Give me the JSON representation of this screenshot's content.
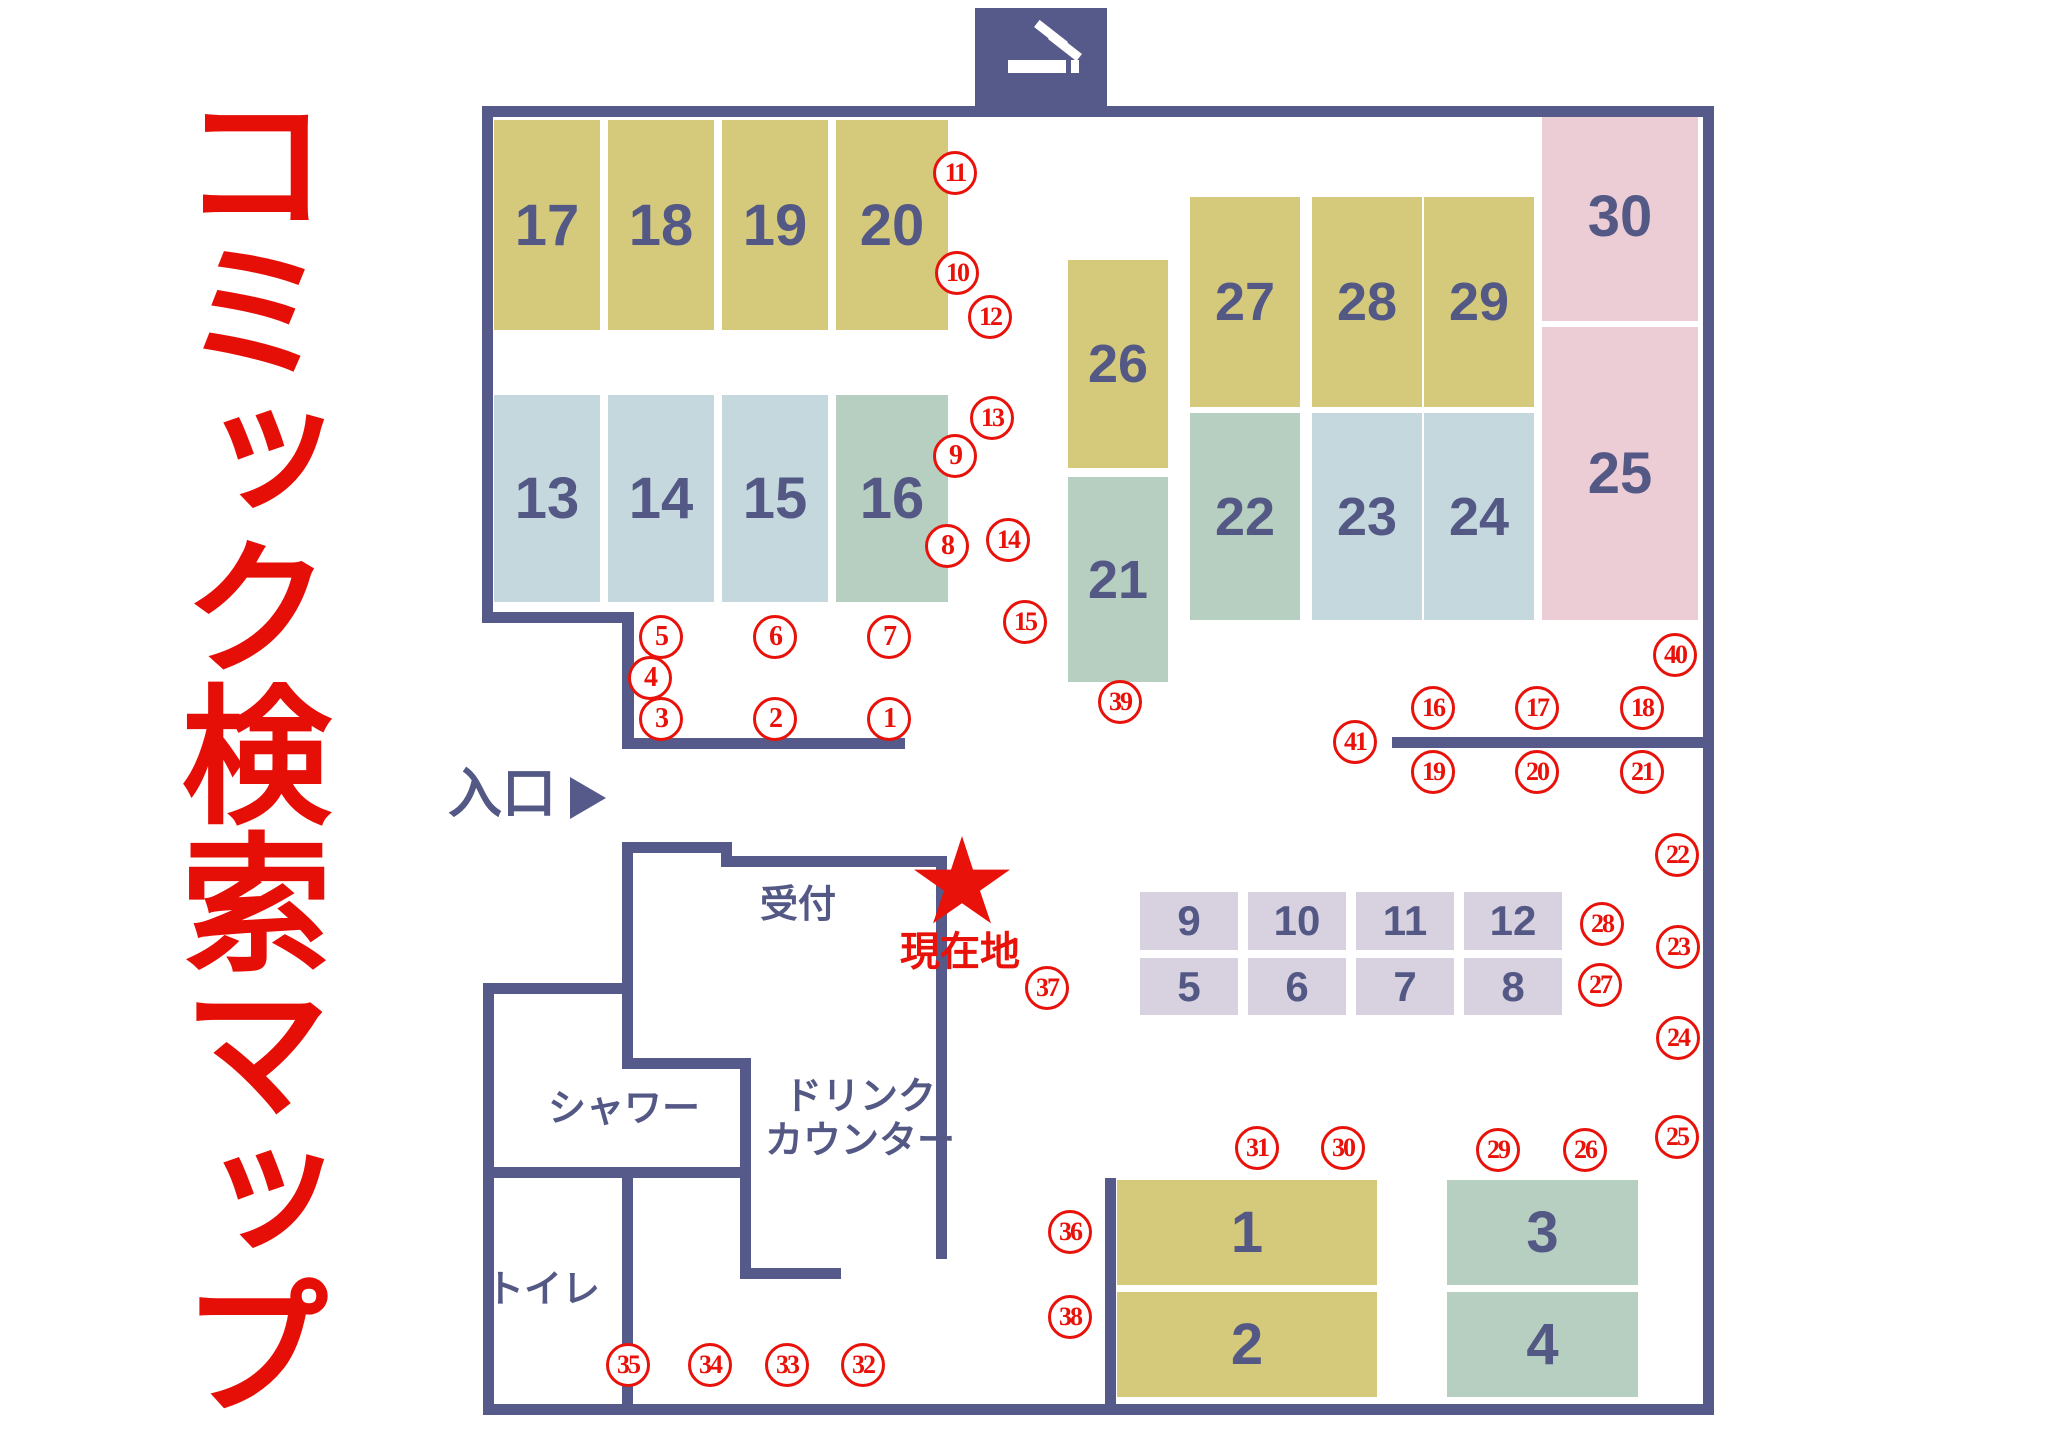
{
  "title": {
    "text": "コミック検索マップ",
    "color": "#e60f08"
  },
  "palette": {
    "wall": "#565a8b",
    "shelf_text": "#545885",
    "marker_red": "#e8120a",
    "yellow": "#d5ca7c",
    "lightblue": "#c5d8de",
    "green": "#b7cfc0",
    "pink": "#eccdd6",
    "lavender": "#d7d1e0"
  },
  "smoking_sign": {
    "icon": "cigarette-icon",
    "x": 975,
    "y": 8,
    "w": 132,
    "h": 99
  },
  "current_location": {
    "label": "現在地",
    "star_x": 962,
    "star_y": 884
  },
  "walls": [
    {
      "x": 482,
      "y": 106,
      "w": 1232,
      "h": 11
    },
    {
      "x": 1703,
      "y": 106,
      "w": 11,
      "h": 1309
    },
    {
      "x": 483,
      "y": 1404,
      "w": 1231,
      "h": 11
    },
    {
      "x": 482,
      "y": 106,
      "w": 11,
      "h": 517
    },
    {
      "x": 482,
      "y": 612,
      "w": 152,
      "h": 11
    },
    {
      "x": 622,
      "y": 612,
      "w": 12,
      "h": 137
    },
    {
      "x": 622,
      "y": 738,
      "w": 283,
      "h": 11
    },
    {
      "x": 483,
      "y": 983,
      "w": 11,
      "h": 432
    },
    {
      "x": 483,
      "y": 983,
      "w": 150,
      "h": 11
    },
    {
      "x": 483,
      "y": 1167,
      "w": 268,
      "h": 11
    },
    {
      "x": 622,
      "y": 1167,
      "w": 11,
      "h": 248
    },
    {
      "x": 622,
      "y": 842,
      "w": 11,
      "h": 227
    },
    {
      "x": 622,
      "y": 842,
      "w": 110,
      "h": 11
    },
    {
      "x": 721,
      "y": 842,
      "w": 11,
      "h": 25
    },
    {
      "x": 721,
      "y": 856,
      "w": 226,
      "h": 11
    },
    {
      "x": 936,
      "y": 856,
      "w": 11,
      "h": 403
    },
    {
      "x": 622,
      "y": 1058,
      "w": 129,
      "h": 11
    },
    {
      "x": 740,
      "y": 1058,
      "w": 11,
      "h": 221
    },
    {
      "x": 740,
      "y": 1268,
      "w": 101,
      "h": 11
    },
    {
      "x": 1105,
      "y": 1178,
      "w": 11,
      "h": 237
    },
    {
      "x": 1392,
      "y": 737,
      "w": 312,
      "h": 11
    }
  ],
  "shelves": [
    {
      "label": "17",
      "x": 494,
      "y": 120,
      "w": 106,
      "h": 210,
      "color": "yellow",
      "fs": 58
    },
    {
      "label": "18",
      "x": 608,
      "y": 120,
      "w": 106,
      "h": 210,
      "color": "yellow",
      "fs": 58
    },
    {
      "label": "19",
      "x": 722,
      "y": 120,
      "w": 106,
      "h": 210,
      "color": "yellow",
      "fs": 58
    },
    {
      "label": "20",
      "x": 836,
      "y": 120,
      "w": 112,
      "h": 210,
      "color": "yellow",
      "fs": 58
    },
    {
      "label": "13",
      "x": 494,
      "y": 395,
      "w": 106,
      "h": 207,
      "color": "lightblue",
      "fs": 58
    },
    {
      "label": "14",
      "x": 608,
      "y": 395,
      "w": 106,
      "h": 207,
      "color": "lightblue",
      "fs": 58
    },
    {
      "label": "15",
      "x": 722,
      "y": 395,
      "w": 106,
      "h": 207,
      "color": "lightblue",
      "fs": 58
    },
    {
      "label": "16",
      "x": 836,
      "y": 395,
      "w": 112,
      "h": 207,
      "color": "green",
      "fs": 58
    },
    {
      "label": "26",
      "x": 1068,
      "y": 260,
      "w": 100,
      "h": 208,
      "color": "yellow",
      "fs": 54
    },
    {
      "label": "27",
      "x": 1190,
      "y": 197,
      "w": 110,
      "h": 210,
      "color": "yellow",
      "fs": 54
    },
    {
      "label": "28",
      "x": 1312,
      "y": 197,
      "w": 110,
      "h": 210,
      "color": "yellow",
      "fs": 54
    },
    {
      "label": "29",
      "x": 1424,
      "y": 197,
      "w": 110,
      "h": 210,
      "color": "yellow",
      "fs": 54
    },
    {
      "label": "30",
      "x": 1542,
      "y": 112,
      "w": 156,
      "h": 209,
      "color": "pink",
      "fs": 58
    },
    {
      "label": "21",
      "x": 1068,
      "y": 477,
      "w": 100,
      "h": 205,
      "color": "green",
      "fs": 54
    },
    {
      "label": "22",
      "x": 1190,
      "y": 413,
      "w": 110,
      "h": 207,
      "color": "green",
      "fs": 54
    },
    {
      "label": "23",
      "x": 1312,
      "y": 413,
      "w": 110,
      "h": 207,
      "color": "lightblue",
      "fs": 54
    },
    {
      "label": "24",
      "x": 1424,
      "y": 413,
      "w": 110,
      "h": 207,
      "color": "lightblue",
      "fs": 54
    },
    {
      "label": "25",
      "x": 1542,
      "y": 327,
      "w": 156,
      "h": 293,
      "color": "pink",
      "fs": 58
    },
    {
      "label": "9",
      "x": 1140,
      "y": 892,
      "w": 98,
      "h": 58,
      "color": "lavender",
      "fs": 42
    },
    {
      "label": "10",
      "x": 1248,
      "y": 892,
      "w": 98,
      "h": 58,
      "color": "lavender",
      "fs": 42
    },
    {
      "label": "11",
      "x": 1356,
      "y": 892,
      "w": 98,
      "h": 58,
      "color": "lavender",
      "fs": 42
    },
    {
      "label": "12",
      "x": 1464,
      "y": 892,
      "w": 98,
      "h": 58,
      "color": "lavender",
      "fs": 42
    },
    {
      "label": "5",
      "x": 1140,
      "y": 958,
      "w": 98,
      "h": 57,
      "color": "lavender",
      "fs": 42
    },
    {
      "label": "6",
      "x": 1248,
      "y": 958,
      "w": 98,
      "h": 57,
      "color": "lavender",
      "fs": 42
    },
    {
      "label": "7",
      "x": 1356,
      "y": 958,
      "w": 98,
      "h": 57,
      "color": "lavender",
      "fs": 42
    },
    {
      "label": "8",
      "x": 1464,
      "y": 958,
      "w": 98,
      "h": 57,
      "color": "lavender",
      "fs": 42
    },
    {
      "label": "1",
      "x": 1117,
      "y": 1180,
      "w": 260,
      "h": 105,
      "color": "yellow",
      "fs": 58
    },
    {
      "label": "2",
      "x": 1117,
      "y": 1292,
      "w": 260,
      "h": 105,
      "color": "yellow",
      "fs": 58
    },
    {
      "label": "3",
      "x": 1447,
      "y": 1180,
      "w": 191,
      "h": 105,
      "color": "green",
      "fs": 58
    },
    {
      "label": "4",
      "x": 1447,
      "y": 1292,
      "w": 191,
      "h": 105,
      "color": "green",
      "fs": 58
    }
  ],
  "markers": [
    {
      "n": "1",
      "x": 889,
      "y": 719
    },
    {
      "n": "2",
      "x": 775,
      "y": 719
    },
    {
      "n": "3",
      "x": 661,
      "y": 719
    },
    {
      "n": "4",
      "x": 650,
      "y": 678
    },
    {
      "n": "5",
      "x": 661,
      "y": 637
    },
    {
      "n": "6",
      "x": 775,
      "y": 637
    },
    {
      "n": "7",
      "x": 889,
      "y": 637
    },
    {
      "n": "8",
      "x": 947,
      "y": 546
    },
    {
      "n": "9",
      "x": 955,
      "y": 456
    },
    {
      "n": "10",
      "x": 957,
      "y": 273
    },
    {
      "n": "11",
      "x": 955,
      "y": 173
    },
    {
      "n": "12",
      "x": 990,
      "y": 317
    },
    {
      "n": "13",
      "x": 992,
      "y": 418
    },
    {
      "n": "14",
      "x": 1008,
      "y": 540
    },
    {
      "n": "15",
      "x": 1025,
      "y": 622
    },
    {
      "n": "16",
      "x": 1433,
      "y": 708
    },
    {
      "n": "17",
      "x": 1537,
      "y": 708
    },
    {
      "n": "18",
      "x": 1642,
      "y": 708
    },
    {
      "n": "19",
      "x": 1433,
      "y": 772
    },
    {
      "n": "20",
      "x": 1537,
      "y": 772
    },
    {
      "n": "21",
      "x": 1642,
      "y": 772
    },
    {
      "n": "22",
      "x": 1677,
      "y": 855
    },
    {
      "n": "23",
      "x": 1678,
      "y": 947
    },
    {
      "n": "24",
      "x": 1678,
      "y": 1038
    },
    {
      "n": "25",
      "x": 1677,
      "y": 1137
    },
    {
      "n": "26",
      "x": 1585,
      "y": 1150
    },
    {
      "n": "27",
      "x": 1600,
      "y": 985
    },
    {
      "n": "28",
      "x": 1602,
      "y": 924
    },
    {
      "n": "29",
      "x": 1498,
      "y": 1150
    },
    {
      "n": "30",
      "x": 1343,
      "y": 1148
    },
    {
      "n": "31",
      "x": 1257,
      "y": 1148
    },
    {
      "n": "32",
      "x": 863,
      "y": 1365
    },
    {
      "n": "33",
      "x": 787,
      "y": 1365
    },
    {
      "n": "34",
      "x": 710,
      "y": 1365
    },
    {
      "n": "35",
      "x": 628,
      "y": 1365
    },
    {
      "n": "36",
      "x": 1070,
      "y": 1232
    },
    {
      "n": "37",
      "x": 1047,
      "y": 988
    },
    {
      "n": "38",
      "x": 1070,
      "y": 1317
    },
    {
      "n": "39",
      "x": 1120,
      "y": 702
    },
    {
      "n": "40",
      "x": 1675,
      "y": 655
    },
    {
      "n": "41",
      "x": 1355,
      "y": 742
    }
  ],
  "labels": [
    {
      "id": "entrance",
      "text": "入口",
      "x": 448,
      "y": 763,
      "size": 54,
      "color": "navy",
      "arrow": true
    },
    {
      "id": "reception",
      "text": "受付",
      "x": 760,
      "y": 884,
      "size": 38,
      "color": "navy"
    },
    {
      "id": "current-location",
      "text": "現在地",
      "x": 900,
      "y": 929,
      "size": 40,
      "color": "red"
    },
    {
      "id": "drink-counter",
      "text": "ドリンク\nカウンター",
      "x": 755,
      "y": 1076,
      "w": 210,
      "size": 38,
      "color": "navy",
      "align": "center"
    },
    {
      "id": "shower",
      "text": "シャワー",
      "x": 548,
      "y": 1088,
      "size": 38,
      "color": "navy"
    },
    {
      "id": "toilet",
      "text": "トイレ",
      "x": 486,
      "y": 1269,
      "size": 38,
      "color": "navy"
    }
  ]
}
